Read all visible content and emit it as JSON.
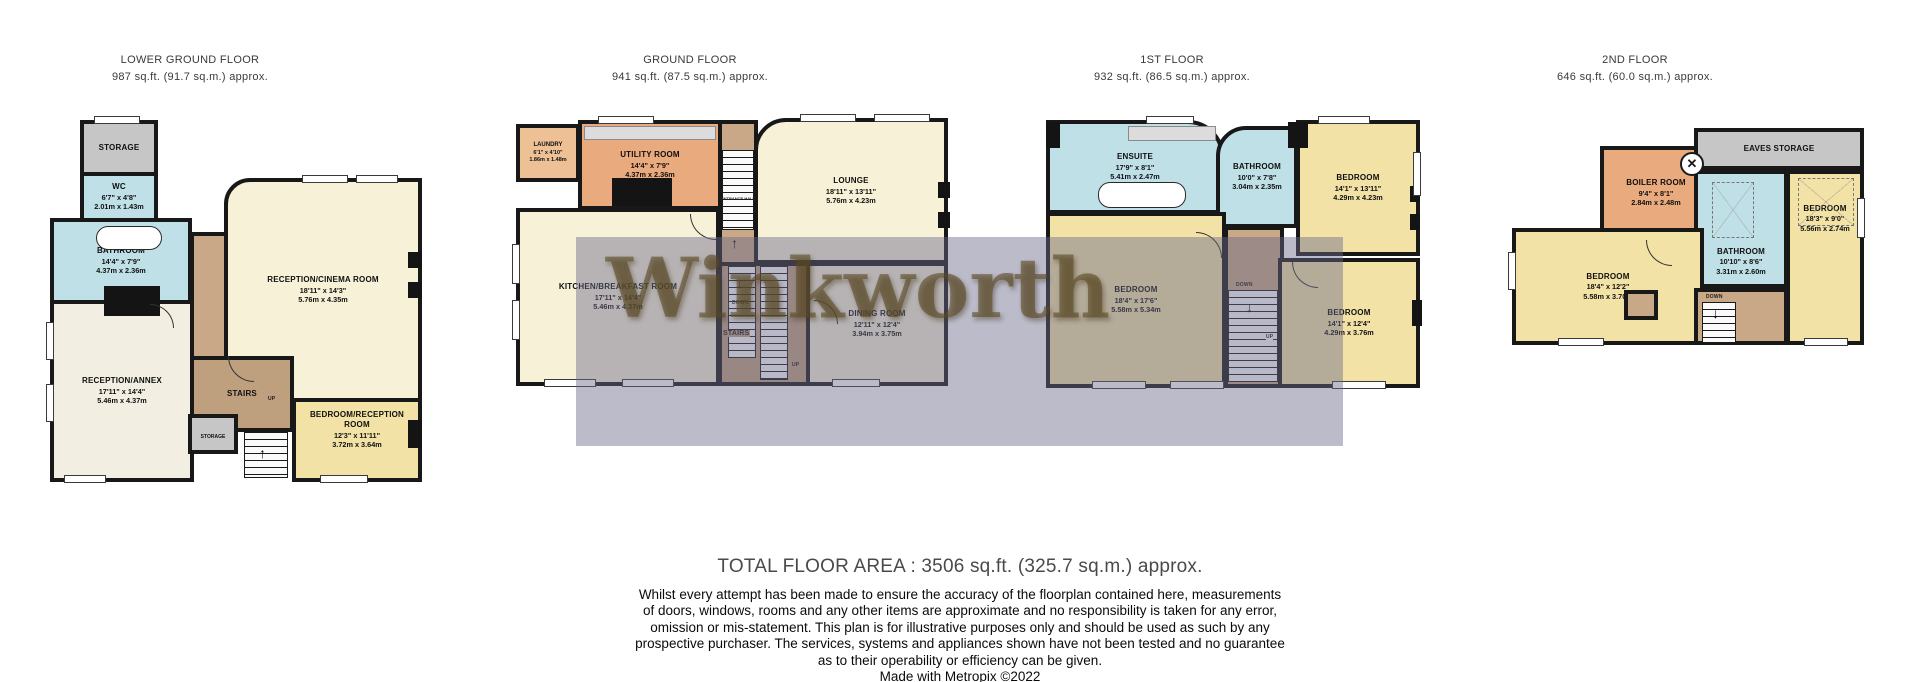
{
  "floors": [
    {
      "title": "LOWER GROUND FLOOR",
      "area": "987 sq.ft. (91.7 sq.m.) approx.",
      "rooms": {
        "storage_top": {
          "name": "STORAGE"
        },
        "wc": {
          "name": "WC",
          "imperial": "6'7\" x 4'8\"",
          "metric": "2.01m x 1.43m"
        },
        "bathroom": {
          "name": "BATHROOM",
          "imperial": "14'4\" x 7'9\"",
          "metric": "4.37m x 2.36m"
        },
        "cinema": {
          "name": "RECEPTION/CINEMA ROOM",
          "imperial": "18'11\" x 14'3\"",
          "metric": "5.76m x 4.35m"
        },
        "annex": {
          "name": "RECEPTION/ANNEX",
          "imperial": "17'11\" x 14'4\"",
          "metric": "5.46m x 4.37m"
        },
        "stairs": {
          "name": "STAIRS",
          "up": "UP"
        },
        "storage_small": {
          "name": "STORAGE"
        },
        "bedroom_reception": {
          "name": "BEDROOM/RECEPTION ROOM",
          "imperial": "12'3\" x 11'11\"",
          "metric": "3.72m x 3.64m"
        }
      }
    },
    {
      "title": "GROUND FLOOR",
      "area": "941 sq.ft. (87.5 sq.m.) approx.",
      "rooms": {
        "laundry": {
          "name": "LAUNDRY",
          "imperial": "6'1\" x 4'10\"",
          "metric": "1.86m x 1.48m"
        },
        "utility": {
          "name": "UTILITY ROOM",
          "imperial": "14'4\" x 7'9\"",
          "metric": "4.37m x 2.36m"
        },
        "entrance_hall": {
          "name": "ENTRANCE HALL"
        },
        "lounge": {
          "name": "LOUNGE",
          "imperial": "18'11\" x 13'11\"",
          "metric": "5.76m x 4.23m"
        },
        "kitchen": {
          "name": "KITCHEN/BREAKFAST ROOM",
          "imperial": "17'11\" x 14'4\"",
          "metric": "5.46m x 4.37m"
        },
        "stairs": {
          "name": "STAIRS",
          "down": "DOWN",
          "up": "UP"
        },
        "dining": {
          "name": "DINING ROOM",
          "imperial": "12'11\" x 12'4\"",
          "metric": "3.94m x 3.75m"
        }
      }
    },
    {
      "title": "1ST FLOOR",
      "area": "932 sq.ft. (86.5 sq.m.) approx.",
      "rooms": {
        "ensuite": {
          "name": "ENSUITE",
          "imperial": "17'9\" x 8'1\"",
          "metric": "5.41m x 2.47m"
        },
        "bathroom": {
          "name": "BATHROOM",
          "imperial": "10'0\" x 7'8\"",
          "metric": "3.04m x 2.35m"
        },
        "bedroom_top": {
          "name": "BEDROOM",
          "imperial": "14'1\" x 13'11\"",
          "metric": "4.29m x 4.23m"
        },
        "bedroom_large": {
          "name": "BEDROOM",
          "imperial": "18'4\" x 17'6\"",
          "metric": "5.58m x 5.34m"
        },
        "stairs": {
          "down": "DOWN",
          "up": "UP"
        },
        "bedroom_bottom": {
          "name": "BEDROOM",
          "imperial": "14'1\" x 12'4\"",
          "metric": "4.29m x 3.76m"
        }
      }
    },
    {
      "title": "2ND FLOOR",
      "area": "646 sq.ft. (60.0 sq.m.) approx.",
      "rooms": {
        "boiler": {
          "name": "BOILER ROOM",
          "imperial": "9'4\" x 8'1\"",
          "metric": "2.84m x 2.48m"
        },
        "eaves": {
          "name": "EAVES STORAGE"
        },
        "bathroom": {
          "name": "BATHROOM",
          "imperial": "10'10\" x 8'6\"",
          "metric": "3.31m x 2.60m"
        },
        "bedroom_right": {
          "name": "BEDROOM",
          "imperial": "18'3\" x 9'0\"",
          "metric": "5.56m x 2.74m"
        },
        "bedroom_left": {
          "name": "BEDROOM",
          "imperial": "18'4\" x 12'2\"",
          "metric": "5.58m x 3.70m"
        },
        "stairs": {
          "down": "DOWN"
        }
      }
    }
  ],
  "watermark": "Winkworth",
  "icons": {
    "up_arrow": "↑",
    "down_arrow": "↓",
    "cross": "✕"
  },
  "footer": {
    "total_area": "TOTAL FLOOR AREA : 3506 sq.ft. (325.7 sq.m.) approx.",
    "disclaimer": "Whilst every attempt has been made to ensure the accuracy of the floorplan contained here, measurements\nof doors, windows, rooms and any other items are approximate and no responsibility is taken for any error,\nomission or mis-statement. This plan is for illustrative purposes only and should be used as such by any\nprospective purchaser. The services, systems and appliances shown have not been tested and no guarantee\nas to their operability or efficiency can be given.",
    "credit": "Made with Metropix ©2022"
  },
  "legend_colors": {
    "wall": "#181818",
    "bathroom_blue": "#bfe0e6",
    "bedroom_yellow": "#f2e2a6",
    "reception_cream": "#f7f1d8",
    "utility_orange": "#e9aa7e",
    "stairs_tan": "#c8a887",
    "storage_gray": "#c6c6c6",
    "watermark_band": "#68688a",
    "watermark_text": "#5c4a24"
  }
}
